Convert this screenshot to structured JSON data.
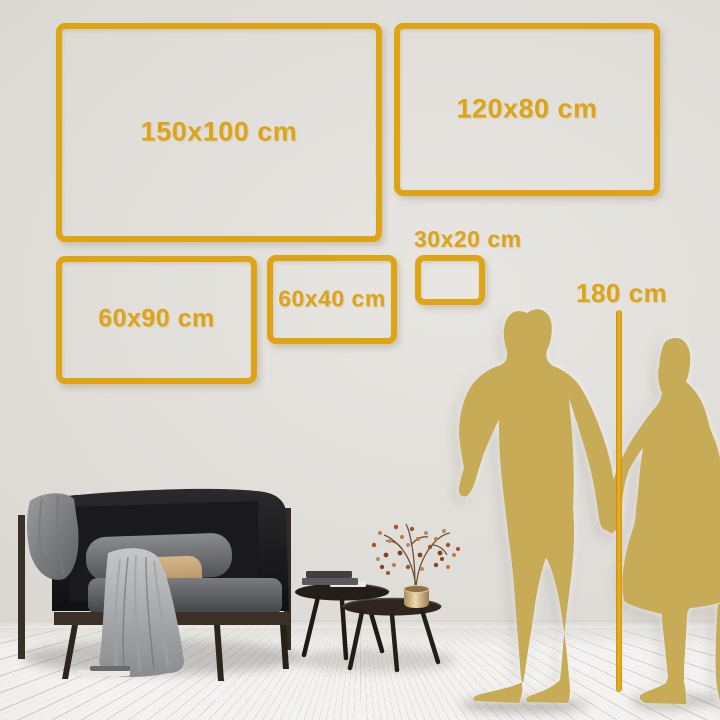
{
  "size_guide": {
    "frames": [
      {
        "label": "150x100 cm"
      },
      {
        "label": "120x80 cm"
      },
      {
        "label": "60x90 cm"
      },
      {
        "label": "60x40 cm"
      },
      {
        "label": "30x20 cm"
      }
    ],
    "reference_height": {
      "label": "180 cm"
    }
  },
  "colors": {
    "accent_gold": "#DEA414",
    "silhouette_gold": "#C8AB57"
  }
}
